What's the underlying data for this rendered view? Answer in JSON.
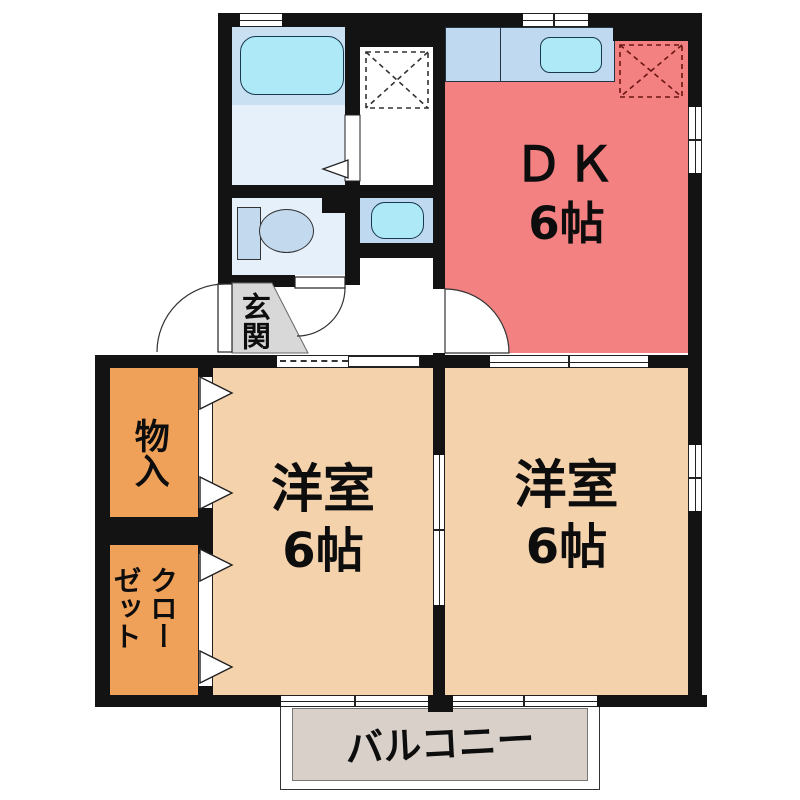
{
  "floorplan": {
    "title": "2DK apartment floor plan",
    "rooms": {
      "dk": {
        "name": "ＤＫ",
        "size": "6帖"
      },
      "western_left": {
        "name": "洋室",
        "size": "6帖"
      },
      "western_right": {
        "name": "洋室",
        "size": "6帖"
      },
      "storage": {
        "label": "物入"
      },
      "closet": {
        "label": "クローゼット"
      },
      "entrance": {
        "label": "玄関"
      },
      "balcony": {
        "label": "バルコニー"
      }
    },
    "colors": {
      "wall": "#131313",
      "dk": "#F38181",
      "room": "#F4D2AC",
      "closet": "#F0A159",
      "bathU": "#C9DFF2",
      "bathL": "#E6F0FB",
      "fix": "#AEE9F8",
      "mid": "#C3D9EE",
      "counter": "#BFD9F0",
      "entgrey": "#D8D8D8",
      "balcony": "#D9D0CA"
    }
  }
}
